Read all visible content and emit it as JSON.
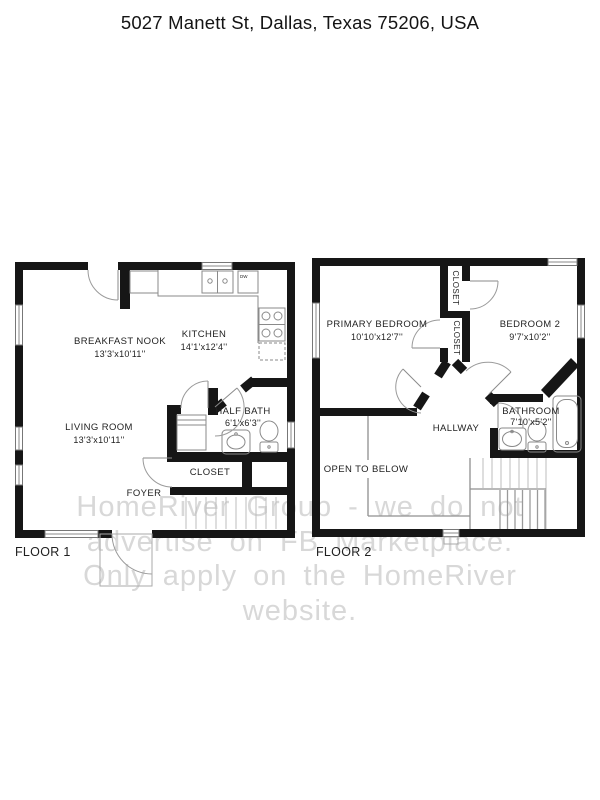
{
  "title": "5027 Manett St, Dallas, Texas 75206, USA",
  "watermark": {
    "lines": [
      "HomeRiver Group - we do not",
      "advertise on FB Marketplace.",
      "Only apply on the HomeRiver",
      "website."
    ]
  },
  "floor1": {
    "label": "FLOOR 1",
    "rooms": {
      "breakfast_nook": {
        "name": "BREAKFAST NOOK",
        "dims": "13'3'x10'11''"
      },
      "kitchen": {
        "name": "KITCHEN",
        "dims": "14'1'x12'4''"
      },
      "living_room": {
        "name": "LIVING ROOM",
        "dims": "13'3'x10'11''"
      },
      "half_bath": {
        "name": "HALF BATH",
        "dims": "6'1'x6'3''"
      },
      "closet": {
        "name": "CLOSET"
      },
      "foyer": {
        "name": "FOYER"
      }
    },
    "appliances": {
      "dishwasher": "DW"
    }
  },
  "floor2": {
    "label": "FLOOR 2",
    "rooms": {
      "primary_bedroom": {
        "name": "PRIMARY BEDROOM",
        "dims": "10'10'x12'7''"
      },
      "bedroom2": {
        "name": "BEDROOM 2",
        "dims": "9'7'x10'2''"
      },
      "bathroom": {
        "name": "BATHROOM",
        "dims": "7'10'x5'2''"
      },
      "hallway": {
        "name": "HALLWAY"
      },
      "open_to_below": {
        "name": "OPEN TO BELOW"
      },
      "closet_top": {
        "name": "CLOSET"
      },
      "closet_bottom": {
        "name": "CLOSET"
      }
    }
  },
  "colors": {
    "wall": "#161616",
    "line": "#8a8a8a",
    "light": "#bdbdbd",
    "watermark": "#d8d8d8",
    "text": "#1f1f1f"
  }
}
